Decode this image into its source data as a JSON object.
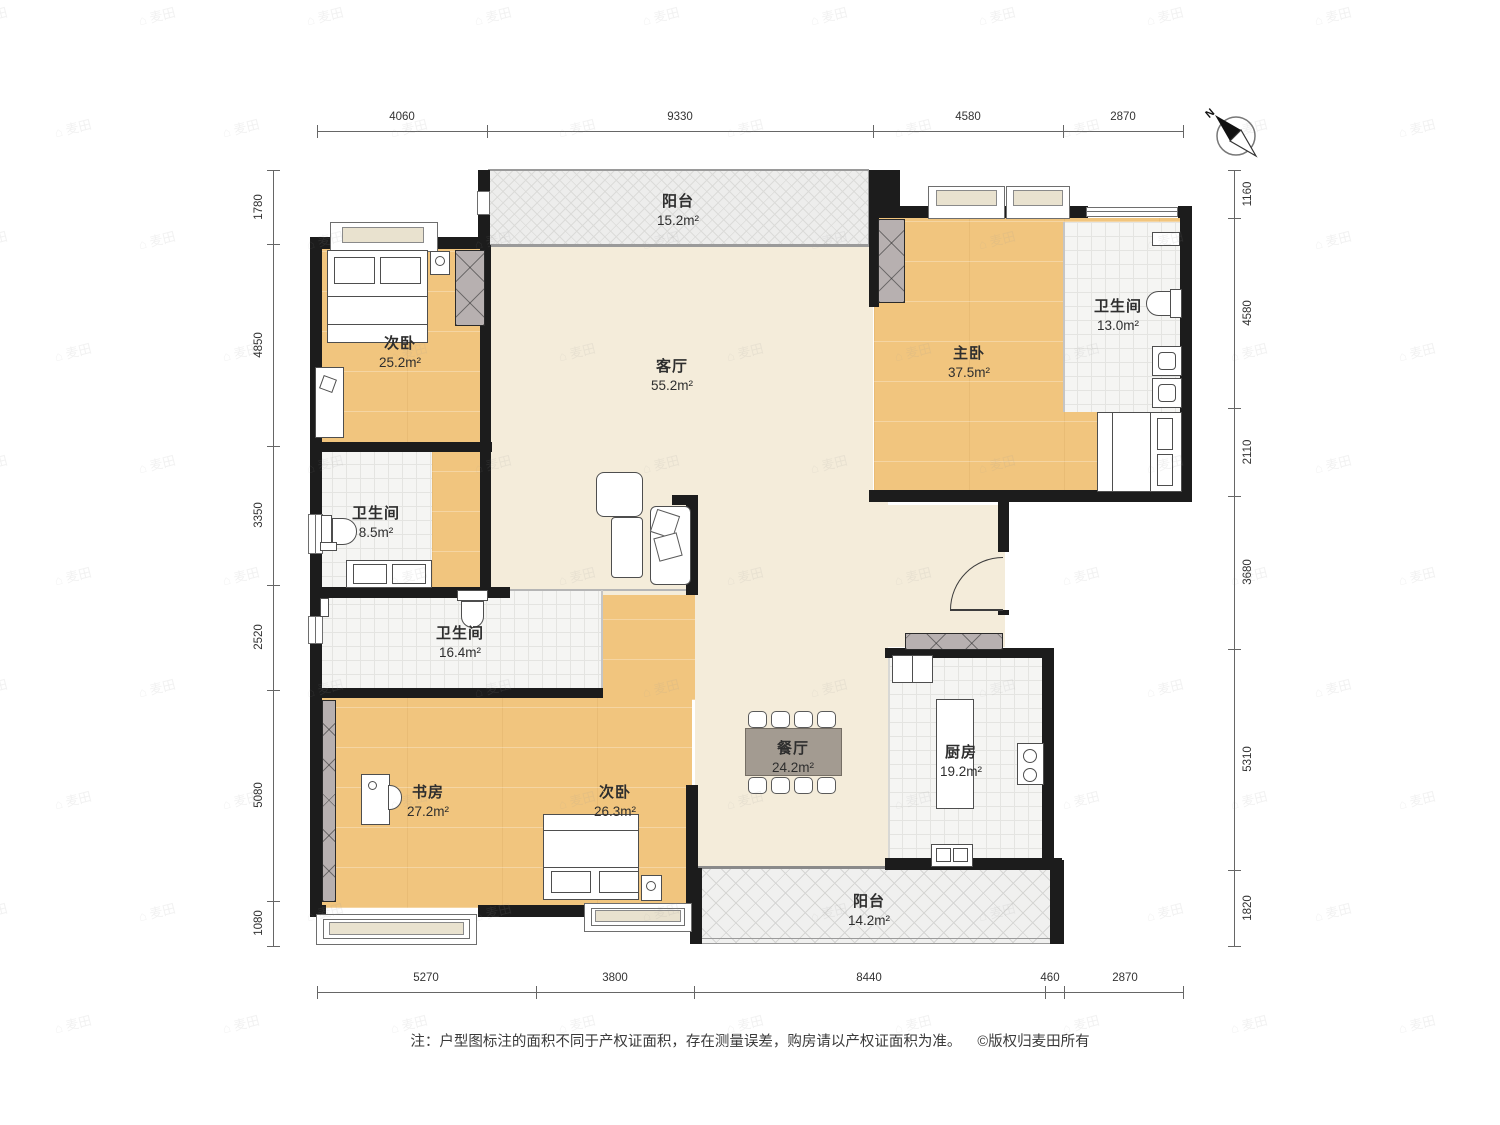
{
  "compass": {
    "label": "N"
  },
  "rooms": [
    {
      "name": "阳台",
      "area": "15.2m²"
    },
    {
      "name": "次卧",
      "area": "25.2m²"
    },
    {
      "name": "客厅",
      "area": "55.2m²"
    },
    {
      "name": "主卧",
      "area": "37.5m²"
    },
    {
      "name": "卫生间",
      "area": "13.0m²"
    },
    {
      "name": "卫生间",
      "area": "8.5m²"
    },
    {
      "name": "卫生间",
      "area": "16.4m²"
    },
    {
      "name": "书房",
      "area": "27.2m²"
    },
    {
      "name": "次卧",
      "area": "26.3m²"
    },
    {
      "name": "餐厅",
      "area": "24.2m²"
    },
    {
      "name": "厨房",
      "area": "19.2m²"
    },
    {
      "name": "阳台",
      "area": "14.2m²"
    }
  ],
  "dimensions": {
    "top": [
      "4060",
      "9330",
      "4580",
      "2870"
    ],
    "bottom": [
      "5270",
      "3800",
      "8440",
      "460",
      "2870"
    ],
    "left": [
      "1780",
      "4850",
      "3350",
      "2520",
      "5080",
      "1080"
    ],
    "right": [
      "1160",
      "4580",
      "2110",
      "3680",
      "5310",
      "1820"
    ]
  },
  "footer": {
    "note": "注：户型图标注的面积不同于产权证面积，存在测量误差，购房请以产权证面积为准。",
    "copyright": "©版权归麦田所有"
  },
  "watermark_text": "麦田"
}
